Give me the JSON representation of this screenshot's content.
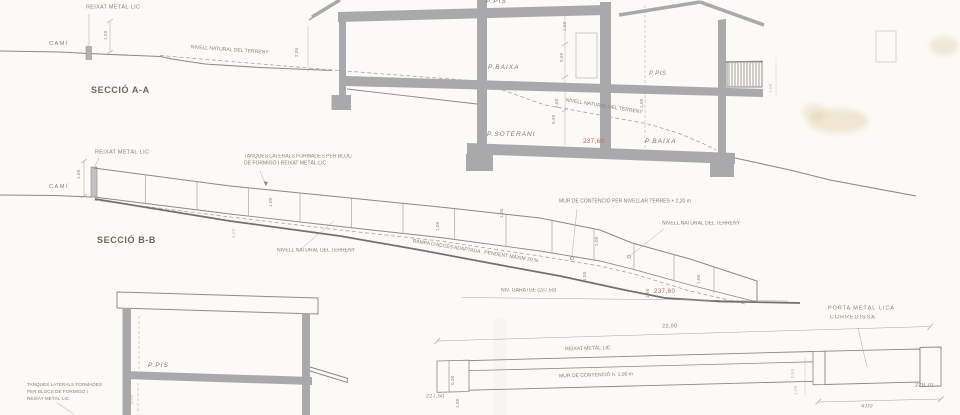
{
  "colors": {
    "paper": "#fbfaf6",
    "ink": "#8b8985",
    "wall": "#a9a9ac",
    "heavy": "#71706c",
    "faint_line": "#a7a5a0",
    "text": "#85817a",
    "title_text": "#6b6862",
    "red": "#b85a4e"
  },
  "seccio_aa": {
    "title": "SECCIÓ A-A",
    "cami": "CAMÍ",
    "reixat": "REIXAT METÀL·LIC",
    "nivell_left": "NIVELL NATURAL DEL TERRENY",
    "nivell_right": "NIVELL NATURAL DEL TERRENY",
    "p_pis_top": "P.PIS",
    "p_baixa_left": "P.BAIXA",
    "p_soterani": "P.SOTERANI",
    "p_pis_right": "P.PIS",
    "p_baixa_right": "P.BAIXA",
    "elev_red": "237,60",
    "dims": {
      "fence_h": "1,50",
      "left": "2,95",
      "a": "1,60",
      "b": "0,90",
      "c": "2,60",
      "d": "0,90",
      "e": "1,00",
      "f": "1,00"
    }
  },
  "seccio_bb": {
    "title": "SECCIÓ B-B",
    "cami": "CAMÍ",
    "reixat": "REIXAT METÀL·LIC",
    "tanques_1": "TANQUES LATERALS FORMADES PER BLOC",
    "tanques_2": "DE FORMIGÓ I REIXAT METÀL·LIC",
    "nivell_left": "NIVELL NATURAL DEL TERRENY",
    "nivell_right": "NIVELL NATURAL DEL TERRENY",
    "mur": "MUR DE CONTENCIÓ PER NIVELLAR TERRES + 2,20 m",
    "rampa": "RAMPA D'ACCÉS ADAPTADA . PENDENT MÀXIM 20 %",
    "garatge": "NIV. GARATGE (237,50)",
    "elev_red": "237,60",
    "dims": {
      "fence_h": "1,50",
      "p1": "1,00",
      "p2": "1,00",
      "p3": "1,00",
      "p4": "1,00",
      "p5": "1,50",
      "p6": "1,60",
      "p7": "1,00",
      "p8": "0,50"
    }
  },
  "seccio_c": {
    "p_pis": "P.PIS",
    "tanques_1": "TANQUES LATERALS FORMADES",
    "tanques_2": "PER BLOCS DE FORMIGÓ I",
    "tanques_3": "REIXAT METÀL·LIC",
    "dims": {
      "a": "0,30"
    }
  },
  "fence_elevation": {
    "reixat": "REIXAT METÀL·LIC",
    "mur": "MUR DE CONTENCIÓ  h. 1,00 m",
    "porta_1": "PORTA METÀL·LICA",
    "porta_2": "CORREDISSA",
    "dim_total": "22,00",
    "dim_gate": "4,00",
    "elev_left": "227,50",
    "elev_right": "228,70",
    "dims": {
      "a": "0,30",
      "b": "1,00",
      "c": "0,50",
      "d": "1,00"
    }
  }
}
